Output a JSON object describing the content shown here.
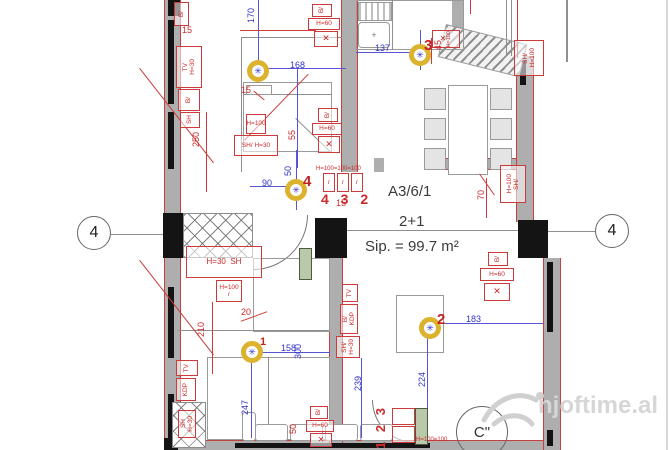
{
  "apartment": {
    "code": "A3/6/1",
    "layout": "2+1",
    "area": "Sip. = 99.7 m²"
  },
  "grid": {
    "axis_left": "4",
    "axis_right": "4",
    "c_marker": "C\""
  },
  "watermark": {
    "text": "njoftime.al"
  },
  "lights": {
    "symbol": "✳",
    "l1": "1",
    "l2": "2",
    "l3": "3",
    "l4": "4"
  },
  "dims_blue": [
    "170",
    "168",
    "137",
    "205",
    "90",
    "50",
    "158",
    "300",
    "247",
    "239",
    "224",
    "183"
  ],
  "dims_red": [
    "15",
    "250",
    "15",
    "55",
    "45",
    "70",
    "15",
    "20",
    "210",
    "50"
  ],
  "ann": {
    "tv": "TV",
    "b": "B/",
    "sh": "SH",
    "shs": "SH/",
    "h30": "H=30",
    "h60": "H=60",
    "h100": "H=100",
    "kdp": "KDP",
    "cross": "✕",
    "hook": "ɾ"
  },
  "sequences": {
    "top": "4 3 2",
    "top_heights": "H=100=100=100",
    "bottom": "1 2 3",
    "bottom_heights": "H=100=100"
  }
}
